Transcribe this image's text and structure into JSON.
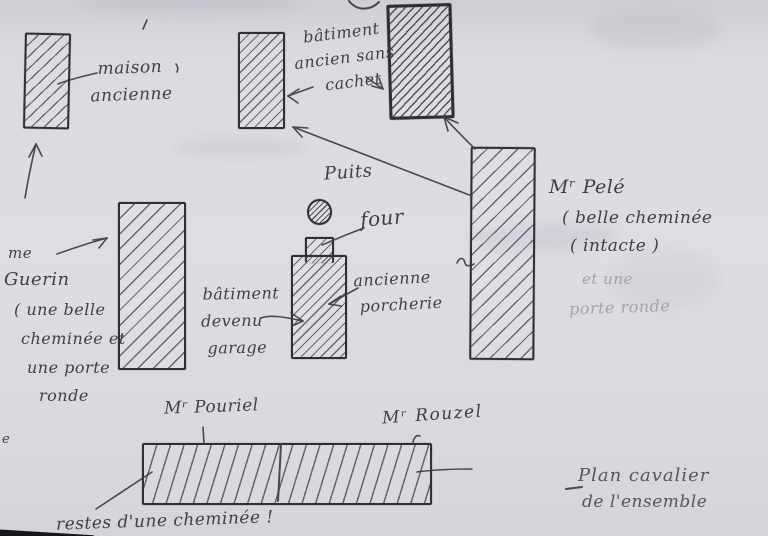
{
  "labels": {
    "maison": {
      "l1": "maison",
      "l2": "ancienne"
    },
    "batiment_ancien": {
      "l1": "bâtiment",
      "l2": "ancien sans",
      "l3": "cachet"
    },
    "puits": "Puits",
    "four": "four",
    "porcherie": {
      "l1": "ancienne",
      "l2": "porcherie"
    },
    "garage": {
      "l1": "bâtiment",
      "l2": "devenu",
      "l3": "garage"
    },
    "guerin": {
      "l1": "me",
      "l2": "Guerin",
      "l3": "( une belle",
      "l4": "cheminée et",
      "l5": "une porte",
      "l6": "ronde"
    },
    "pele": {
      "l1": "Mʳ Pelé",
      "l2": "( belle cheminée",
      "l3": "( intacte )",
      "l4": "et une",
      "l5": "porte ronde"
    },
    "pouriel": "Mʳ Pouriel",
    "rouzel": "Mʳ Rouzel",
    "restes": "restes d'une cheminée !",
    "plan": {
      "l1": "Plan cavalier",
      "l2": "de l'ensemble"
    },
    "stray_letter": "e"
  },
  "colors": {
    "paper": "#dbdade",
    "ink": "#3e3e46",
    "faint_ink": "#a3a2ae"
  }
}
